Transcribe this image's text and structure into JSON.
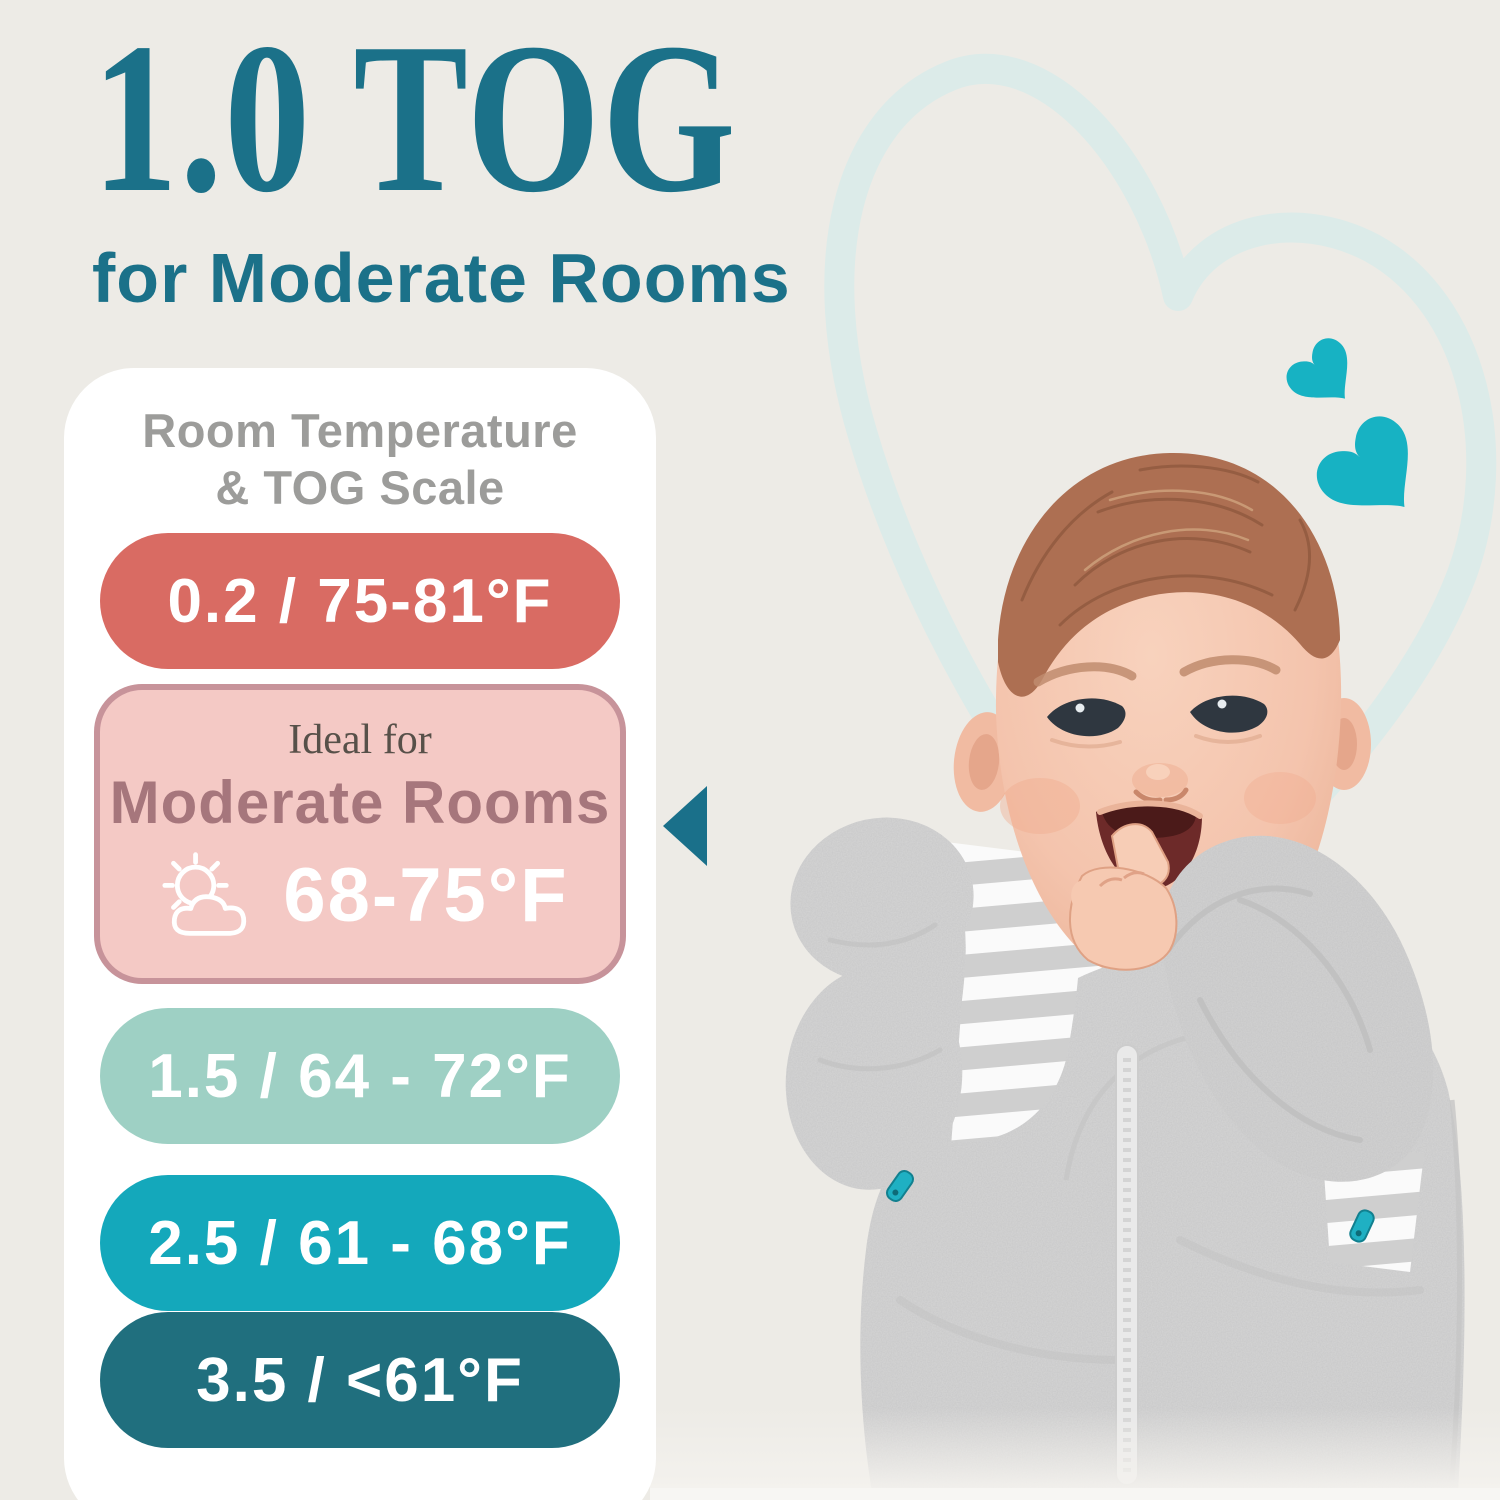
{
  "page": {
    "background_color": "#edebe6",
    "accent_teal": "#1b7189",
    "title": "1.0 TOG",
    "subtitle": "for Moderate Rooms"
  },
  "scale_card": {
    "heading_line1": "Room Temperature",
    "heading_line2": "& TOG Scale",
    "rows": [
      {
        "tog": "0.2",
        "temp": "75-81°F",
        "label": "0.2 / 75-81°F",
        "color": "#d96b63",
        "highlighted": false
      },
      {
        "tog": "1.0",
        "temp": "68-75°F",
        "label": "Moderate Rooms",
        "color": "#f4c9c5",
        "highlighted": true
      },
      {
        "tog": "1.5",
        "temp": "64 - 72°F",
        "label": "1.5 / 64 - 72°F",
        "color": "#9ed0c4",
        "highlighted": false
      },
      {
        "tog": "2.5",
        "temp": "61 - 68°F",
        "label": "2.5 / 61 - 68°F",
        "color": "#14a8bb",
        "highlighted": false
      },
      {
        "tog": "3.5",
        "temp": "<61°F",
        "label": "3.5 / <61°F",
        "color": "#206f7e",
        "highlighted": false
      }
    ],
    "ideal": {
      "prefix": "Ideal for",
      "room_type": "Moderate Rooms",
      "temp_range": "68-75°F",
      "fill": "#f4c9c5",
      "border": "#c7939a",
      "icon": "sun-behind-cloud-icon"
    },
    "pointer_color": "#1a708a"
  },
  "decor": {
    "hearts_color": "#17b2c3",
    "heart_outline_color": "#dcebe9",
    "photo_description": "Smiling baby with hand in mouth wearing gray transitional swaddle suit with wing mitts, striped chest panel, center zipper and teal zipper pulls"
  }
}
